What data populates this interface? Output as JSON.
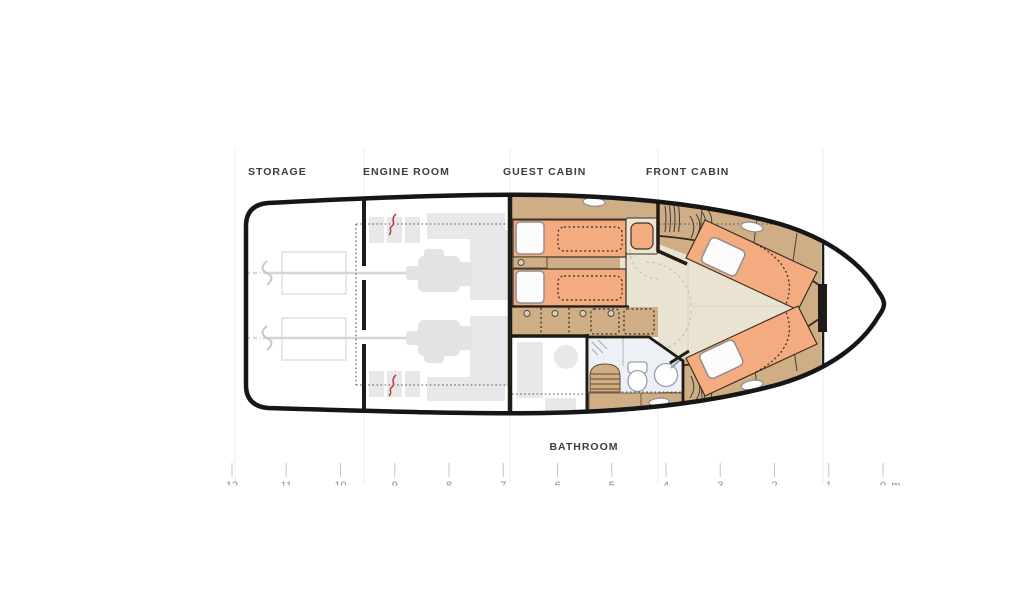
{
  "labels": {
    "storage": "STORAGE",
    "engine_room": "ENGINE ROOM",
    "guest_cabin": "GUEST CABIN",
    "front_cabin": "FRONT CABIN",
    "bathroom": "BATHROOM"
  },
  "ruler": {
    "marks": [
      "12",
      "11",
      "10",
      "9",
      "8",
      "7",
      "6",
      "5",
      "4",
      "3",
      "2",
      "1",
      "0"
    ],
    "unit": "m"
  },
  "colors": {
    "wall": "#1f1b17",
    "hull_outline": "#161616",
    "bed_orange": "#f5ab80",
    "cabinet_tan": "#cfae85",
    "floor_beige": "#e9e3d1",
    "bathroom_floor": "#edf1f7",
    "equipment_gray": "#e8e8ea",
    "symbol_red": "#b5443e",
    "label_text": "#3d3d3d",
    "ruler_text": "#8f8f8f",
    "grid_line": "#ececec"
  }
}
